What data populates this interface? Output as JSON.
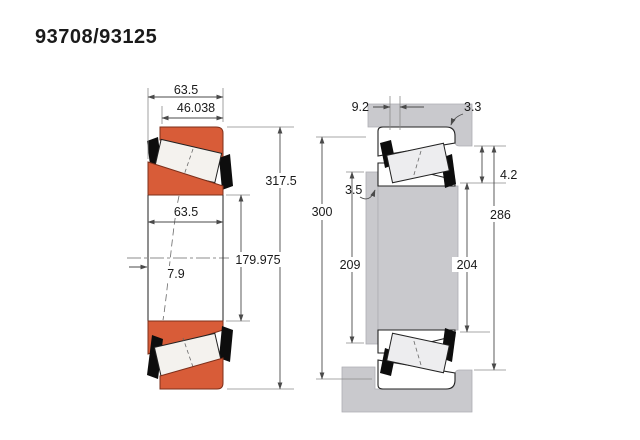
{
  "title": "93708/93125",
  "left_view": {
    "description": "bearing cross-section",
    "dims": {
      "total_width": "63.5",
      "cup_width": "46.038",
      "outer_diameter": "317.5",
      "cone_width": "63.5",
      "bore_diameter": "179.975",
      "load_center_offset": "7.9"
    }
  },
  "right_view": {
    "description": "shaft and housing mounting arrangement",
    "dims": {
      "front_cage_clearance": "9.2",
      "housing_fillet_radius": "3.3",
      "shaft_fillet_radius": "3.5",
      "back_cage_clearance": "4.2",
      "housing_shoulder_diameter": "300",
      "shaft_shoulder_diameter": "209",
      "cone_backface_rib_diameter": "204",
      "housing_backing_diameter": "286"
    }
  },
  "colors": {
    "bearing_ring_orange": "#d85c38",
    "steel_gray": "#c9c9cd",
    "outline_black": "#1a1a1a",
    "dimension_gray": "#4a4a4a",
    "background_white": "#ffffff"
  }
}
